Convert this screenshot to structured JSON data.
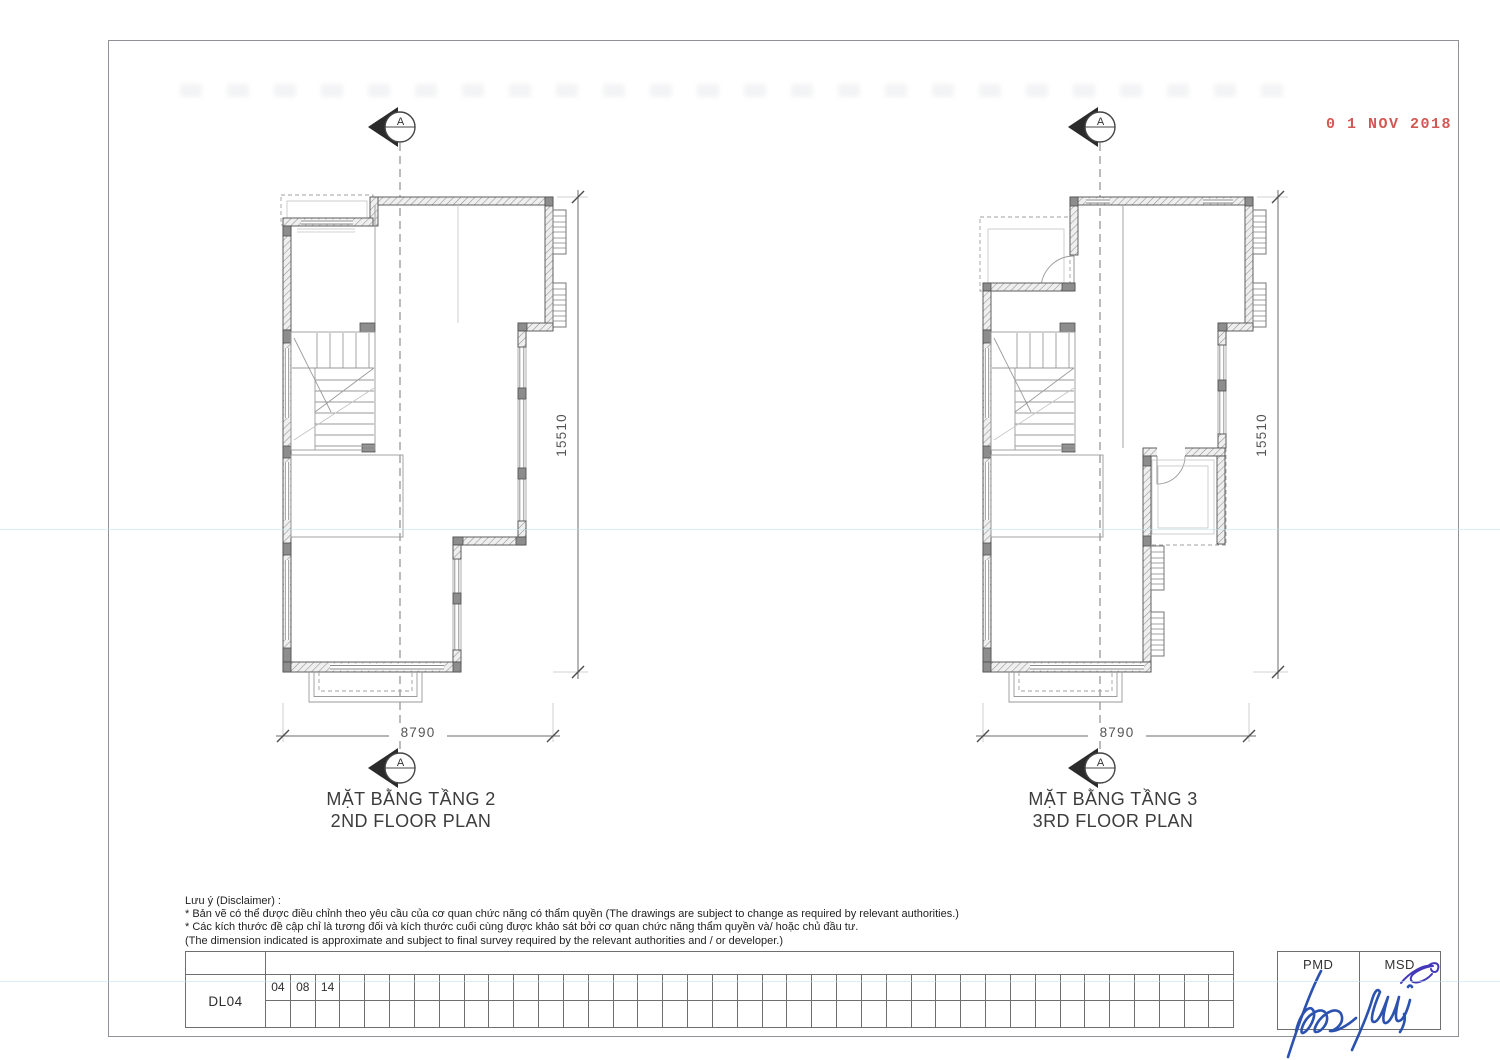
{
  "sheet": {
    "date_stamp": "0 1 NOV 2018"
  },
  "plans": [
    {
      "title_vi": "MẶT BẰNG TẦNG 2",
      "title_en": "2ND FLOOR PLAN",
      "section_letter": "A",
      "dim_vertical": "15510",
      "dim_horizontal": "8790"
    },
    {
      "title_vi": "MẶT BẰNG TẦNG 3",
      "title_en": "3RD FLOOR PLAN",
      "section_letter": "A",
      "dim_vertical": "15510",
      "dim_horizontal": "8790"
    }
  ],
  "disclaimer": {
    "heading": "Lưu ý (Disclaimer) :",
    "lines": [
      "* Bản vẽ có thể được điều chỉnh theo yêu cầu của cơ quan chức năng có thẩm quyền (The drawings are subject to change as required by relevant authorities.)",
      "* Các kích thước đề cập chỉ là tương đối và kích thước cuối cùng được khảo sát bởi cơ quan chức năng thẩm quyền và/ hoặc chủ đầu tư.",
      "(The dimension indicated is approximate and subject to final survey required by the relevant authorities and / or developer.)"
    ]
  },
  "revision_table": {
    "sheet_code": "DL04",
    "cell_values": [
      "04",
      "08",
      "14"
    ],
    "columns": 39,
    "rows": 2
  },
  "approval": {
    "cells": [
      {
        "label": "PMD"
      },
      {
        "label": "MSD"
      }
    ]
  },
  "colors": {
    "stamp_red": "#cf4a45",
    "signature_blue": "#2b52ae",
    "flourish_blue": "#4338b8",
    "scanline_blue": "#bfe0ef"
  }
}
